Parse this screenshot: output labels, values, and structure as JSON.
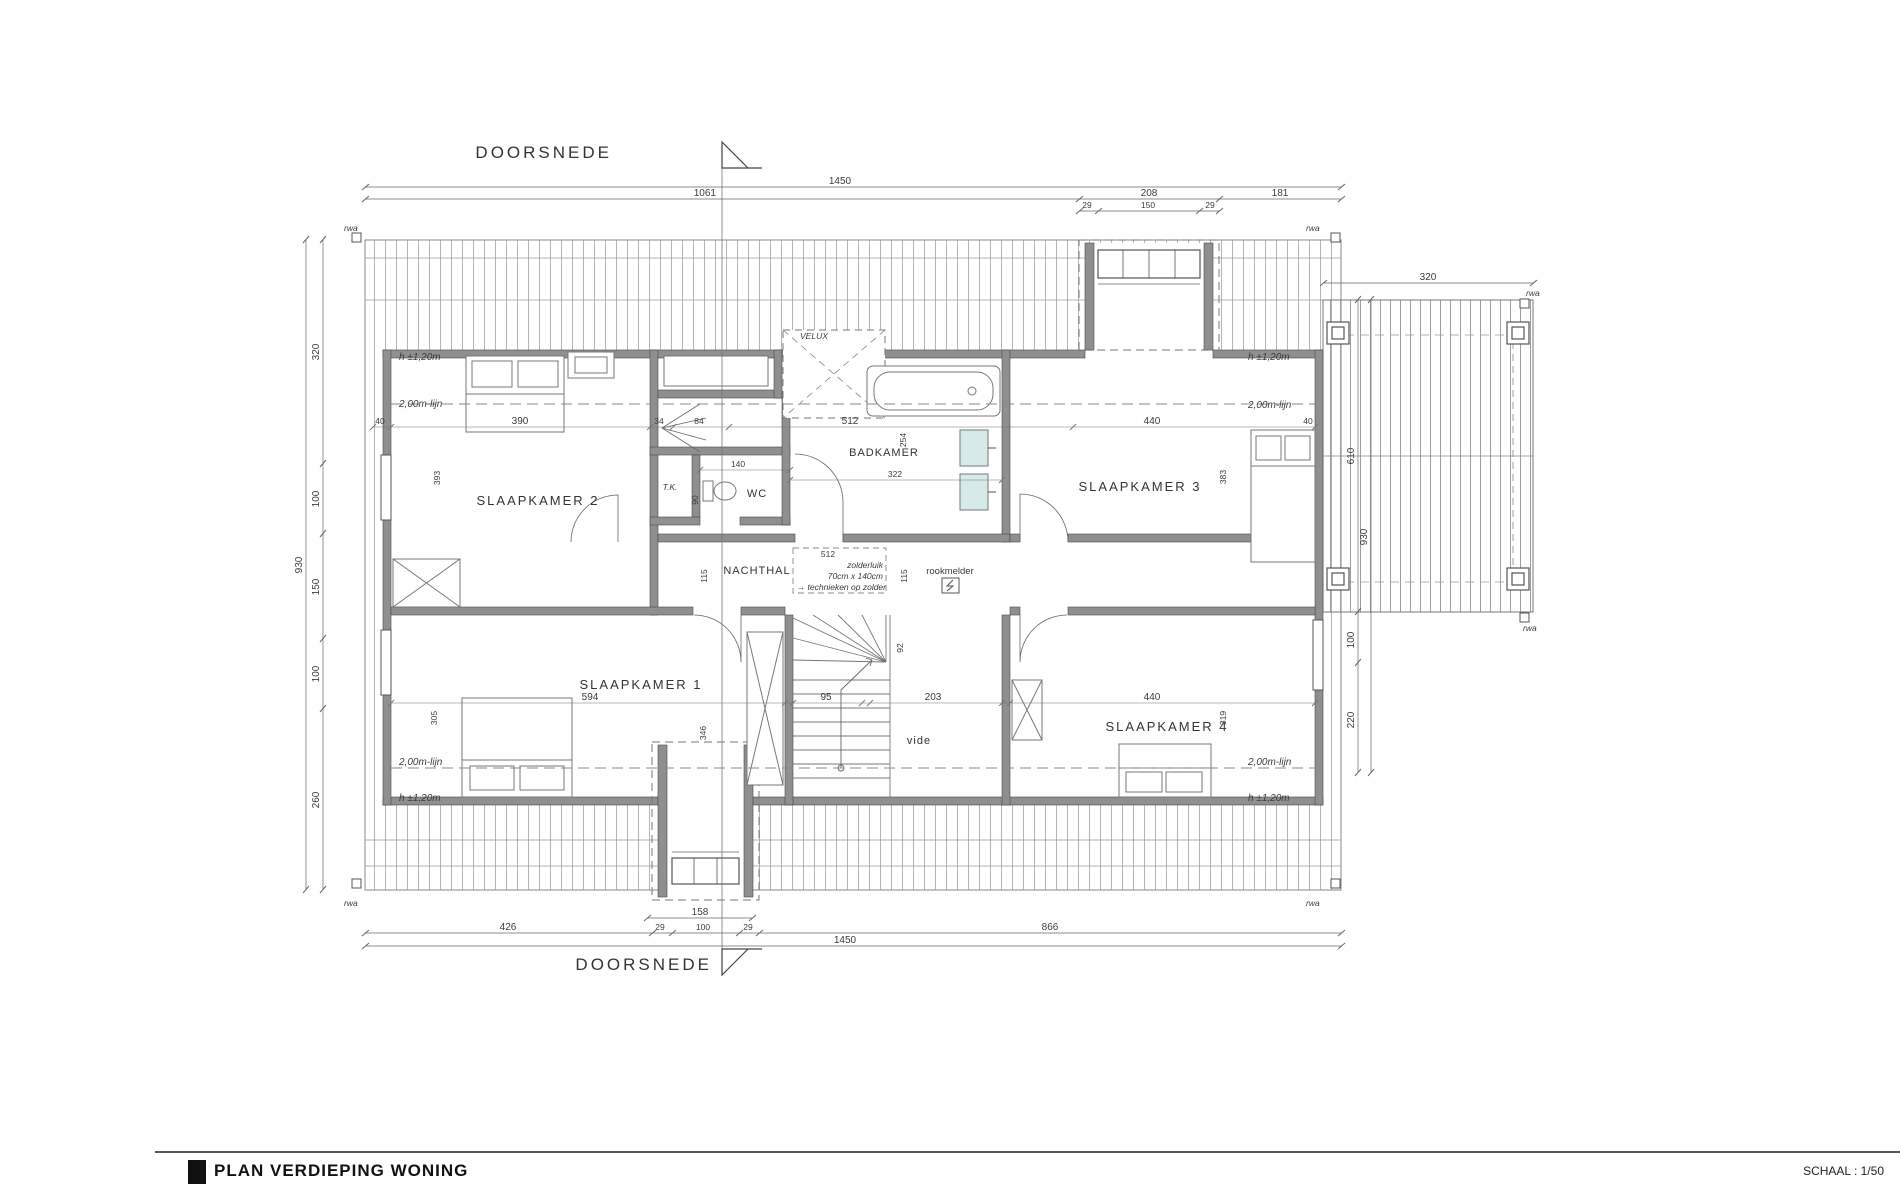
{
  "meta": {
    "title": "PLAN VERDIEPING WONING",
    "scale": "SCHAAL : 1/50"
  },
  "section_labels": {
    "top": "DOORSNEDE",
    "bottom": "DOORSNEDE"
  },
  "rooms": {
    "sk1": "SLAAPKAMER 1",
    "sk2": "SLAAPKAMER 2",
    "sk3": "SLAAPKAMER 3",
    "sk4": "SLAAPKAMER 4",
    "bad": "BADKAMER",
    "wc": "WC",
    "tk": "T.K.",
    "hal": "NACHTHAL",
    "vide": "vide"
  },
  "notes": {
    "velux": "VELUX",
    "rookmelder": "rookmelder",
    "luik_dim": "512",
    "luik1": "zolderluik",
    "luik2": "70cm x 140cm",
    "luik3": "→ technieken op zolder",
    "h120": "h ±1,20m",
    "lijn200": "2,00m-lijn",
    "rwa": "rwa"
  },
  "dims": {
    "top_total": "1450",
    "top_seg": [
      "1061",
      "208",
      "181"
    ],
    "dormer_top": [
      "29",
      "150",
      "29"
    ],
    "bottom_dormer": "158",
    "bottom_seg": [
      "426",
      "29",
      "100",
      "29",
      "866"
    ],
    "bottom_total": "1450",
    "left_seg": [
      "320",
      "100",
      "150",
      "100",
      "260"
    ],
    "left_total": "930",
    "right_top": "320",
    "right_seg": [
      "610",
      "100",
      "220"
    ],
    "right_total": "930",
    "inner_top": [
      "40",
      "390",
      "34",
      "84",
      "512",
      "440",
      "40"
    ],
    "sk2_d": "393",
    "sk3_d": "383",
    "sk1_w": "594",
    "sk1_d": "305",
    "sk1_d2": "346",
    "sk4_w": "440",
    "sk4_d": "319",
    "bad_w": "322",
    "bad_d": "254",
    "wc_w": "140",
    "wc_d": "90",
    "stair_w": "95",
    "vide_w": "203",
    "stair_d": "92",
    "hal_w": "115"
  }
}
